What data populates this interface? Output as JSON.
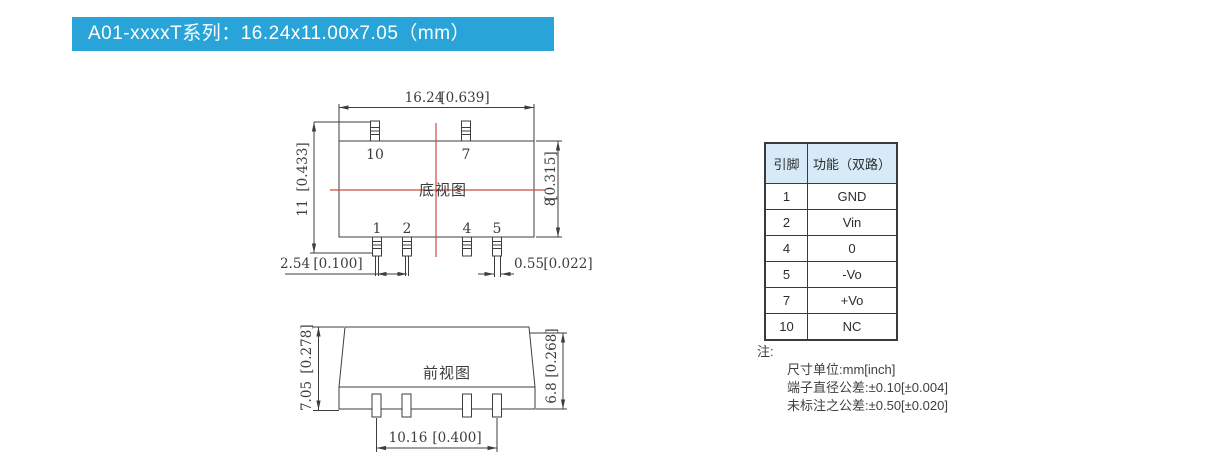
{
  "header": {
    "title": "A01-xxxxT系列：16.24x11.00x7.05（mm）"
  },
  "drawings": {
    "bottom_view": {
      "label": "底视图",
      "pin_labels": {
        "p10": "10",
        "p7": "7",
        "p1": "1",
        "p2": "2",
        "p4": "4",
        "p5": "5"
      },
      "dims": {
        "width_mm": "16.24",
        "width_in": "[0.639]",
        "overall_height_mm": "11",
        "overall_height_in": "[0.433]",
        "body_height_mm": "8",
        "body_height_in": "[0.315]",
        "pin_pitch_mm": "2.54",
        "pin_pitch_in": "[0.100]",
        "pin_width_mm": "0.55",
        "pin_width_in": "[0.022]"
      }
    },
    "front_view": {
      "label": "前视图",
      "dims": {
        "overall_height_mm": "7.05",
        "overall_height_in": "[0.278]",
        "body_height_mm": "6.8",
        "body_height_in": "[0.268]",
        "pin_span_mm": "10.16",
        "pin_span_in": "[0.400]"
      }
    }
  },
  "pin_table": {
    "headers": [
      "引脚",
      "功能（双路）"
    ],
    "rows": [
      [
        "1",
        "GND"
      ],
      [
        "2",
        "Vin"
      ],
      [
        "4",
        "0"
      ],
      [
        "5",
        "-Vo"
      ],
      [
        "7",
        "+Vo"
      ],
      [
        "10",
        "NC"
      ]
    ]
  },
  "notes": {
    "title": "注:",
    "lines": [
      "尺寸单位:mm[inch]",
      "端子直径公差:±0.10[±0.004]",
      "未标注之公差:±0.50[±0.020]"
    ]
  },
  "colors": {
    "banner_bg": "#29a4d9",
    "banner_text": "#ffffff",
    "drawing_line": "#3d3d3d",
    "centerline": "#cf4a44",
    "table_header_bg": "#d6eaf8"
  }
}
